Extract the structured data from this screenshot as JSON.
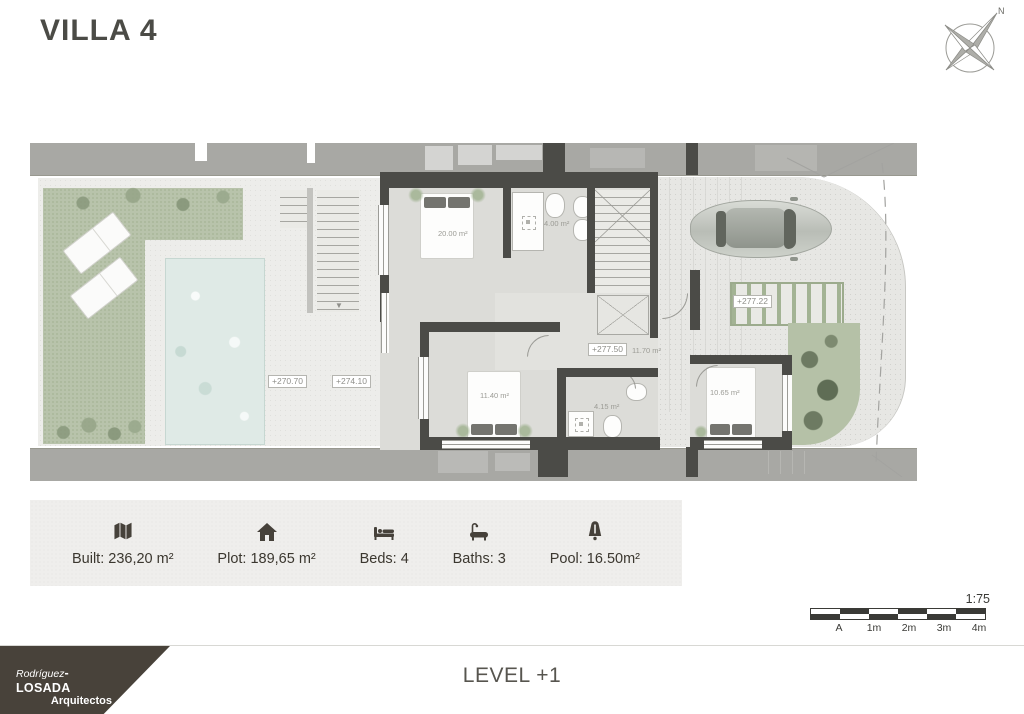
{
  "header": {
    "title": "VILLA 4"
  },
  "compass": {
    "north_label": "N"
  },
  "plan": {
    "area_labels": {
      "bedroom_1": "20.00 m²",
      "bath_1": "4.00 m²",
      "hall": "11.70 m²",
      "bedroom_2": "11.40 m²",
      "bath_2": "4.15 m²",
      "bedroom_3": "10.65 m²"
    },
    "elevation_labels": {
      "garden": "+270.70",
      "terrace": "+274.10",
      "hall": "+277.50",
      "pergola": "+277.22"
    }
  },
  "info_bar": {
    "items": [
      {
        "icon": "map-icon",
        "label": "Built: 236,20 m²"
      },
      {
        "icon": "home-icon",
        "label": "Plot: 189,65 m²"
      },
      {
        "icon": "bed-icon",
        "label": "Beds: 4"
      },
      {
        "icon": "bath-icon",
        "label": "Baths: 3"
      },
      {
        "icon": "pool-icon",
        "label": "Pool: 16.50m²"
      }
    ]
  },
  "scale_bar": {
    "ratio": "1:75",
    "ticks": [
      "A",
      "1m",
      "2m",
      "3m",
      "4m"
    ]
  },
  "footer": {
    "brand": {
      "first": "Rodríguez",
      "last": "-LOSADA",
      "subtitle": "Arquitectos"
    },
    "level": "LEVEL +1"
  }
}
